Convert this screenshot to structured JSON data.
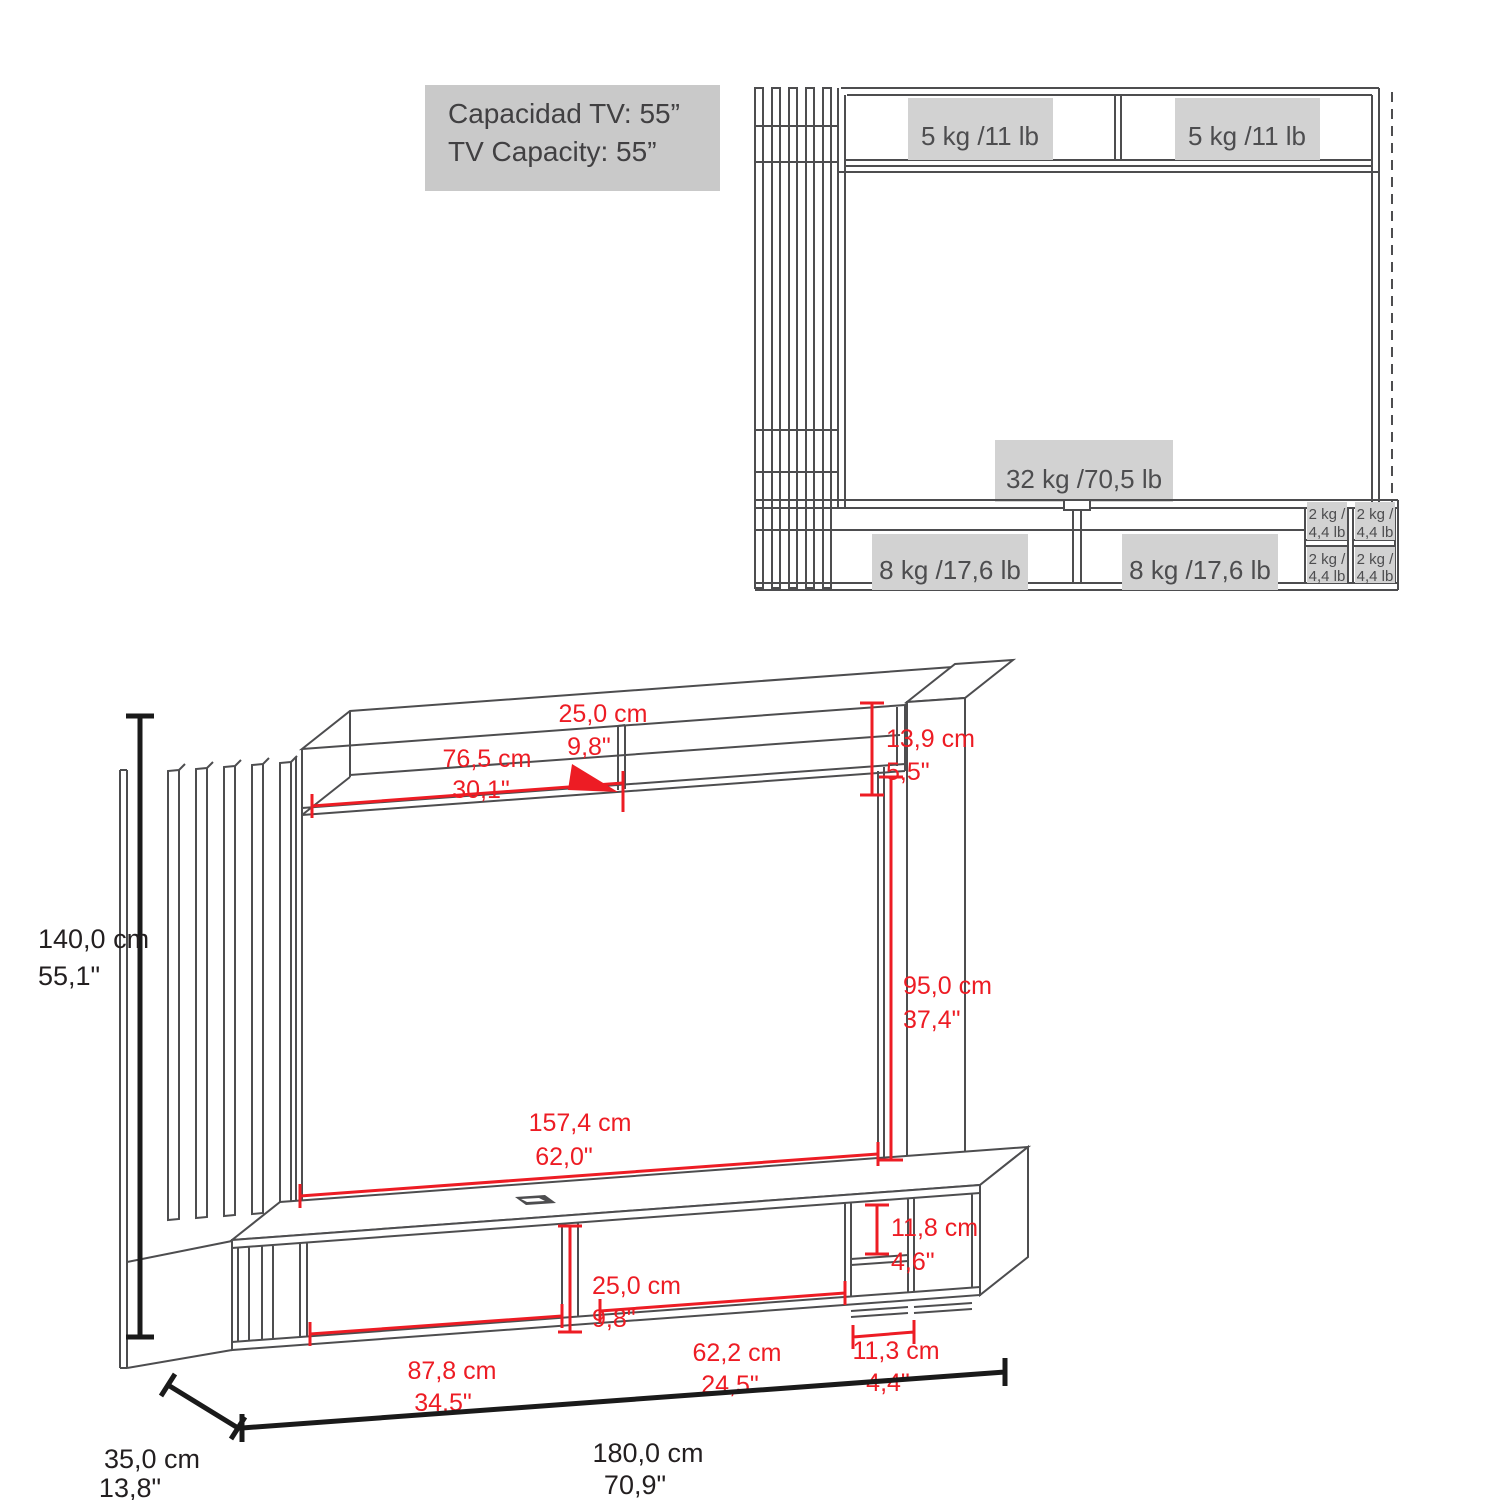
{
  "colors": {
    "line": "#4d4d4f",
    "label_bg": "#d2d2d2",
    "red": "#ed1c24",
    "black": "#1a1a1a",
    "box_bg": "#c9c9c9"
  },
  "title_box": {
    "line1": "Capacidad TV: 55”",
    "line2": "TV Capacity: 55”"
  },
  "front_view": {
    "shelf_left": "5 kg /11 lb",
    "shelf_right": "5 kg /11 lb",
    "tv_panel": "32 kg /70,5 lb",
    "cabinet_left": "8 kg /17,6 lb",
    "cabinet_right": "8 kg /17,6 lb",
    "cubby": {
      "kg": "2 kg /",
      "lb": "4,4 lb"
    }
  },
  "dims": {
    "height": {
      "cm": "140,0 cm",
      "in": "55,1\""
    },
    "width": {
      "cm": "180,0 cm",
      "in": "70,9\""
    },
    "depth": {
      "cm": "35,0 cm",
      "in": "13,8\""
    },
    "shelf_width": {
      "cm": "76,5 cm",
      "in": "30,1\""
    },
    "shelf_depth": {
      "cm": "25,0 cm",
      "in": "9,8\""
    },
    "shelf_height": {
      "cm": "13,9 cm",
      "in": "5,5\""
    },
    "opening_width": {
      "cm": "157,4 cm",
      "in": "62,0\""
    },
    "opening_height": {
      "cm": "95,0 cm",
      "in": "37,4\""
    },
    "console_left_width": {
      "cm": "87,8 cm",
      "in": "34,5\""
    },
    "console_height": {
      "cm": "25,0 cm",
      "in": "9,8\""
    },
    "console_right_width": {
      "cm": "62,2 cm",
      "in": "24,5\""
    },
    "cubby_width": {
      "cm": "11,3 cm",
      "in": "4,4\""
    },
    "cubby_height": {
      "cm": "11,8 cm",
      "in": "4,6\""
    }
  }
}
